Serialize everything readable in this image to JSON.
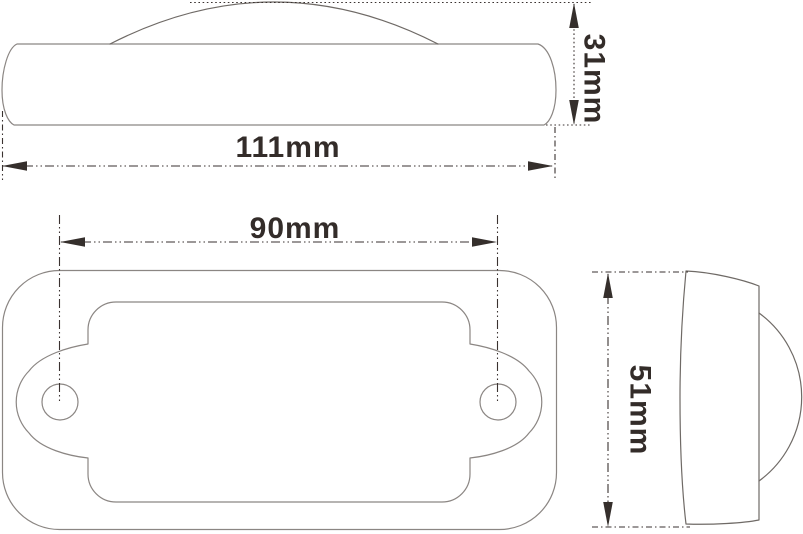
{
  "drawing": {
    "type": "technical-orthographic-views",
    "dimensions": {
      "overall_width": {
        "label": "111mm"
      },
      "overall_height": {
        "label": "31mm"
      },
      "hole_spacing": {
        "label": "90mm"
      },
      "overall_depth": {
        "label": "51mm"
      }
    },
    "colors": {
      "background": "#ffffff",
      "part_outline": "#8b8683",
      "dimension_line": "#3a3230",
      "dimension_text": "#332c29"
    }
  }
}
